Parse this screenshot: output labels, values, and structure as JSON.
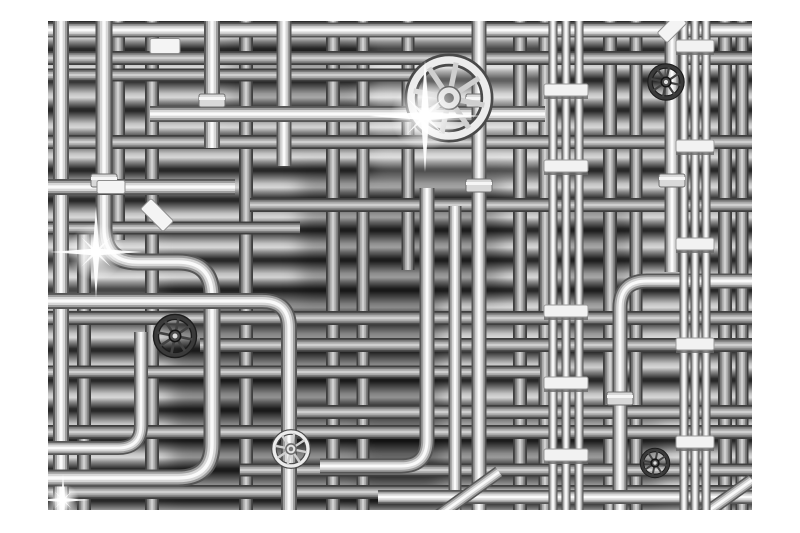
{
  "image": {
    "type": "photographic-render",
    "subject": "Black and white 3D render of a dense maze of chrome industrial pipes with valve wheels, pipe clamps and lens flares, on a white background frame",
    "background_color": "#ffffff"
  },
  "frame": {
    "left": 48,
    "top": 21,
    "width": 704,
    "height": 489
  },
  "palette": {
    "margin": "#ffffff",
    "bg_dark": "#262626",
    "bg_mid": "#8a8a8a",
    "bg_light": "#d8d8d8",
    "pipe_edge": "#565656",
    "pipe_mid": "#9e9e9e",
    "pipe_light": "#d7d7d7",
    "pipe_core": "#fafafa",
    "clamp": "#f2f2f2",
    "wheel_dark": "#303030",
    "flare": "#ffffff"
  },
  "scene": {
    "patches": [
      {
        "x": 170,
        "y": 290,
        "w": 270,
        "h": 210,
        "fill": "#000000",
        "o": 0.32
      },
      {
        "x": 300,
        "y": 170,
        "w": 200,
        "h": 130,
        "fill": "#000000",
        "o": 0.26
      },
      {
        "x": 230,
        "y": 40,
        "w": 130,
        "h": 75,
        "fill": "#000000",
        "o": 0.22
      },
      {
        "x": 360,
        "y": 420,
        "w": 300,
        "h": 85,
        "fill": "#000000",
        "o": 0.28
      },
      {
        "x": 560,
        "y": 200,
        "w": 70,
        "h": 160,
        "fill": "#000000",
        "o": 0.22
      },
      {
        "x": 370,
        "y": 48,
        "w": 180,
        "h": 130,
        "fill": "#ffffff",
        "o": 0.26
      },
      {
        "x": 48,
        "y": 228,
        "w": 110,
        "h": 100,
        "fill": "#ffffff",
        "o": 0.14
      }
    ],
    "mid_pipes": [
      {
        "d": "M 84 230 V 510",
        "w": 12
      },
      {
        "d": "M 118 21 V 240",
        "w": 12
      },
      {
        "d": "M 152 21 V 510",
        "w": 12
      },
      {
        "d": "M 246 21 V 510",
        "w": 12
      },
      {
        "d": "M 333 21 V 510",
        "w": 12
      },
      {
        "d": "M 363 21 V 510",
        "w": 11
      },
      {
        "d": "M 408 21 V 270",
        "w": 11
      },
      {
        "d": "M 520 21 V 510",
        "w": 12
      },
      {
        "d": "M 545 21 V 510",
        "w": 11
      },
      {
        "d": "M 610 21 V 510",
        "w": 12
      },
      {
        "d": "M 636 21 V 510",
        "w": 11
      },
      {
        "d": "M 725 21 V 510",
        "w": 12
      },
      {
        "d": "M 742 21 V 510",
        "w": 11
      },
      {
        "d": "M 48 58 H 752",
        "w": 12
      },
      {
        "d": "M 48 75 H 420",
        "w": 11
      },
      {
        "d": "M 48 142 H 752",
        "w": 12
      },
      {
        "d": "M 250 205 H 752",
        "w": 12
      },
      {
        "d": "M 48 228 H 300",
        "w": 11
      },
      {
        "d": "M 48 318 H 752",
        "w": 12
      },
      {
        "d": "M 200 345 H 752",
        "w": 12
      },
      {
        "d": "M 48 372 H 540",
        "w": 11
      },
      {
        "d": "M 290 412 H 752",
        "w": 12
      },
      {
        "d": "M 48 432 H 752",
        "w": 12
      },
      {
        "d": "M 240 470 H 752",
        "w": 11
      },
      {
        "d": "M 48 492 H 752",
        "w": 12
      }
    ],
    "fg_pipes": [
      {
        "d": "M 48 30 H 752",
        "w": 15
      },
      {
        "d": "M 61 21 V 510",
        "w": 16
      },
      {
        "d": "M 104 21 V 228 Q 104 262 138 262 H 178 Q 212 262 212 296 V 444 Q 212 478 178 478 H 48",
        "w": 17
      },
      {
        "d": "M 48 448 H 118 Q 141 448 141 425 V 332",
        "w": 14
      },
      {
        "d": "M 48 187 H 235",
        "w": 16
      },
      {
        "d": "M 212 21 V 148",
        "w": 16
      },
      {
        "d": "M 284 21 V 166",
        "w": 15
      },
      {
        "d": "M 289 510 V 328 Q 289 301 262 301 H 48",
        "w": 16
      },
      {
        "d": "M 150 114 H 545",
        "w": 16
      },
      {
        "d": "M 479 21 V 510",
        "w": 15
      },
      {
        "d": "M 427 188 V 440 Q 427 466 401 466 H 320",
        "w": 15
      },
      {
        "d": "M 455 206 V 510",
        "w": 13
      },
      {
        "d": "M 672 21 V 272",
        "w": 15
      },
      {
        "d": "M 752 281 H 647 Q 620 281 620 308 V 510",
        "w": 15
      },
      {
        "d": "M 378 497 H 752",
        "w": 14
      },
      {
        "d": "M 438 516 L 499 472",
        "w": 13
      },
      {
        "d": "M 700 517 L 752 480",
        "w": 13
      }
    ],
    "bundle_pipes": [
      {
        "d": "M 553 21 V 510",
        "w": 9
      },
      {
        "d": "M 566 21 V 510",
        "w": 9
      },
      {
        "d": "M 579 21 V 510",
        "w": 9
      },
      {
        "d": "M 684 21 V 510",
        "w": 9
      },
      {
        "d": "M 695 21 V 510",
        "w": 9
      },
      {
        "d": "M 706 21 V 510",
        "w": 9
      }
    ],
    "clamps": [
      {
        "cx": 566,
        "w": 44,
        "ys": [
          90,
          166,
          311,
          383,
          455
        ]
      },
      {
        "cx": 695,
        "w": 38,
        "ys": [
          46,
          146,
          244,
          344,
          442
        ]
      }
    ],
    "collars": [
      {
        "x": 479,
        "y": 100
      },
      {
        "x": 479,
        "y": 185
      },
      {
        "x": 212,
        "y": 100
      },
      {
        "x": 620,
        "y": 398
      },
      {
        "x": 104,
        "y": 180
      },
      {
        "x": 672,
        "y": 180
      }
    ],
    "brackets": [
      {
        "x": 165,
        "y": 46,
        "w": 30,
        "h": 15,
        "rot": 0
      },
      {
        "x": 111,
        "y": 187,
        "w": 28,
        "h": 13,
        "rot": 0
      },
      {
        "x": 157,
        "y": 215,
        "w": 32,
        "h": 15,
        "rot": 45
      },
      {
        "x": 672,
        "y": 28,
        "w": 28,
        "h": 14,
        "rot": -45
      }
    ],
    "wheels": [
      {
        "x": 449,
        "y": 98,
        "r": 38,
        "style": "bright"
      },
      {
        "x": 666,
        "y": 82,
        "r": 16,
        "style": "dark"
      },
      {
        "x": 175,
        "y": 336,
        "r": 19,
        "style": "dark"
      },
      {
        "x": 291,
        "y": 449,
        "r": 17,
        "style": "bright"
      },
      {
        "x": 655,
        "y": 463,
        "r": 13,
        "style": "dark"
      }
    ],
    "flares": [
      {
        "x": 96,
        "y": 252,
        "s": 46
      },
      {
        "x": 425,
        "y": 116,
        "s": 56
      },
      {
        "x": 63,
        "y": 500,
        "s": 26
      }
    ]
  }
}
